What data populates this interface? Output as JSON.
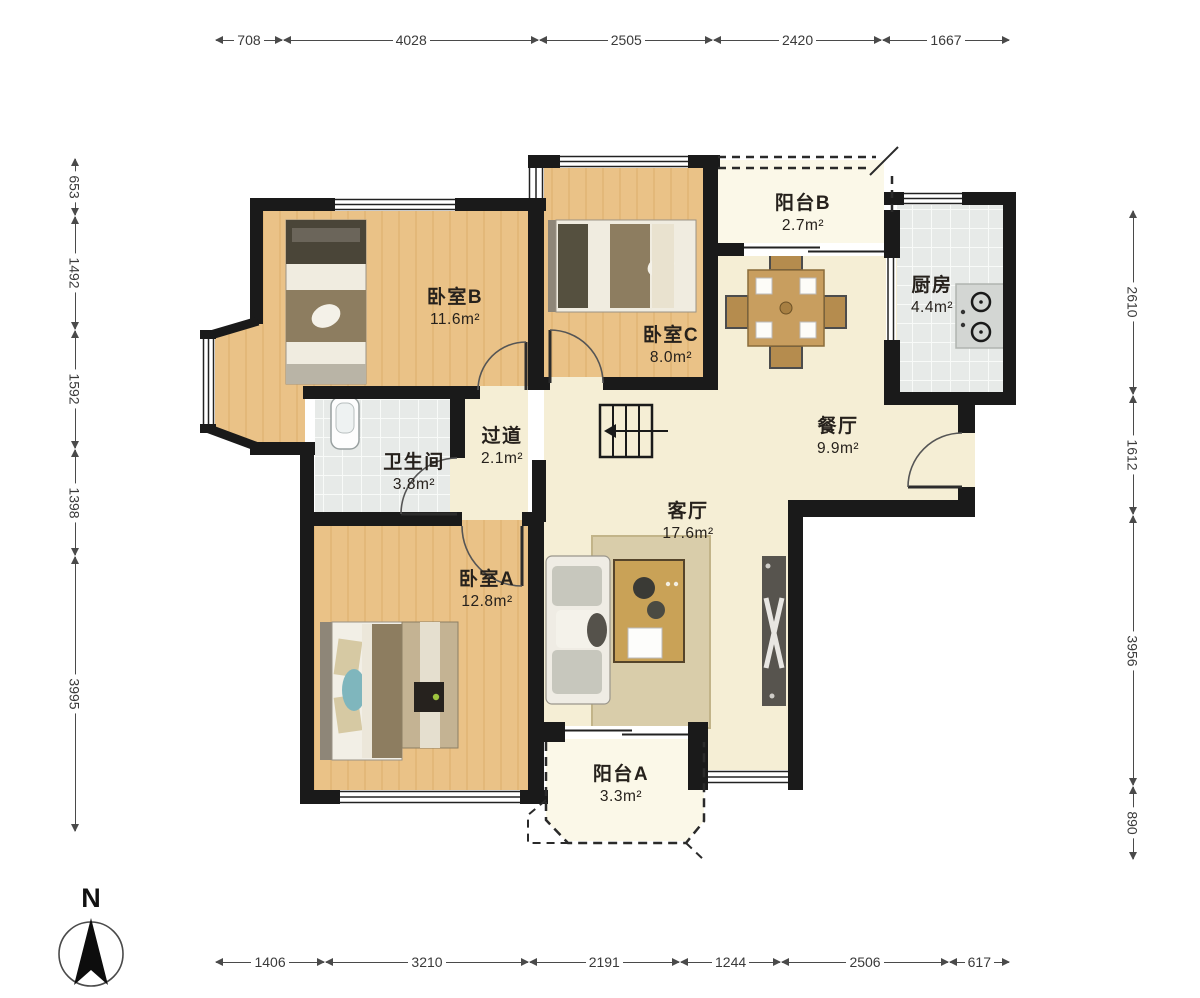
{
  "plan": {
    "rooms": [
      {
        "key": "bedroom-b",
        "name": "卧室B",
        "area": "11.6m²"
      },
      {
        "key": "bedroom-c",
        "name": "卧室C",
        "area": "8.0m²"
      },
      {
        "key": "balcony-b",
        "name": "阳台B",
        "area": "2.7m²"
      },
      {
        "key": "kitchen",
        "name": "厨房",
        "area": "4.4m²"
      },
      {
        "key": "dining",
        "name": "餐厅",
        "area": "9.9m²"
      },
      {
        "key": "hallway",
        "name": "过道",
        "area": "2.1m²"
      },
      {
        "key": "bathroom",
        "name": "卫生间",
        "area": "3.8m²"
      },
      {
        "key": "living",
        "name": "客厅",
        "area": "17.6m²"
      },
      {
        "key": "bedroom-a",
        "name": "卧室A",
        "area": "12.8m²"
      },
      {
        "key": "balcony-a",
        "name": "阳台A",
        "area": "3.3m²"
      }
    ],
    "dimensions_mm": {
      "top": [
        "708",
        "4028",
        "2505",
        "2420",
        "1667"
      ],
      "bottom": [
        "1406",
        "3210",
        "2191",
        "1244",
        "2506",
        "617"
      ],
      "left": [
        "653",
        "1492",
        "1592",
        "1398",
        "3995"
      ],
      "right": [
        "2610",
        "1612",
        "3956",
        "890"
      ]
    },
    "compass": {
      "north_label": "N"
    },
    "colors": {
      "wall": "#1a1a1a",
      "wood_floor": "#eac287",
      "living_floor": "#f5eed5",
      "tile_floor": "#e7eae8",
      "balcony_floor": "#fbf8e8"
    }
  }
}
